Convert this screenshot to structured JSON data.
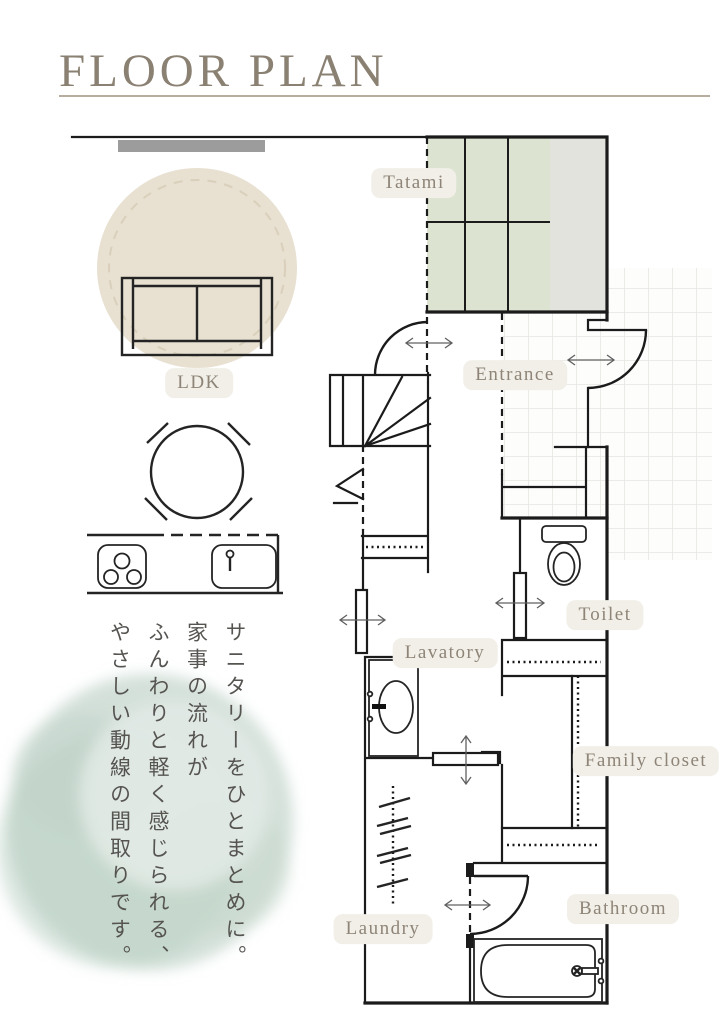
{
  "page": {
    "title": "FLOOR PLAN"
  },
  "room_labels": {
    "tatami": "Tatami",
    "entrance": "Entrance",
    "ldk": "LDK",
    "toilet": "Toilet",
    "lavatory": "Lavatory",
    "family_closet": "Family closet",
    "laundry": "Laundry",
    "bathroom": "Bathroom"
  },
  "caption": {
    "lines": [
      "サニタリーをひとまとめに。",
      "家事の流れが",
      "ふんわりと軽く感じられる、",
      "やさしい動線の間取りです。"
    ]
  },
  "colors": {
    "wall": "#1b1b1b",
    "tatami_green": "#dce3d0",
    "tatami_gray": "#e3e3de",
    "tile_line": "#e5e5e1",
    "label_bg": "#f1efe8",
    "label_text": "#8e8477",
    "title_text": "#8a8173",
    "rule": "#b6ad9f",
    "rug": "#e8e1d2",
    "rug_dash": "#d9cfba",
    "window_bar": "#9c9c9c",
    "watercolor": "#c7d8cf",
    "caption_text": "#565451",
    "arrow": "#606060"
  }
}
